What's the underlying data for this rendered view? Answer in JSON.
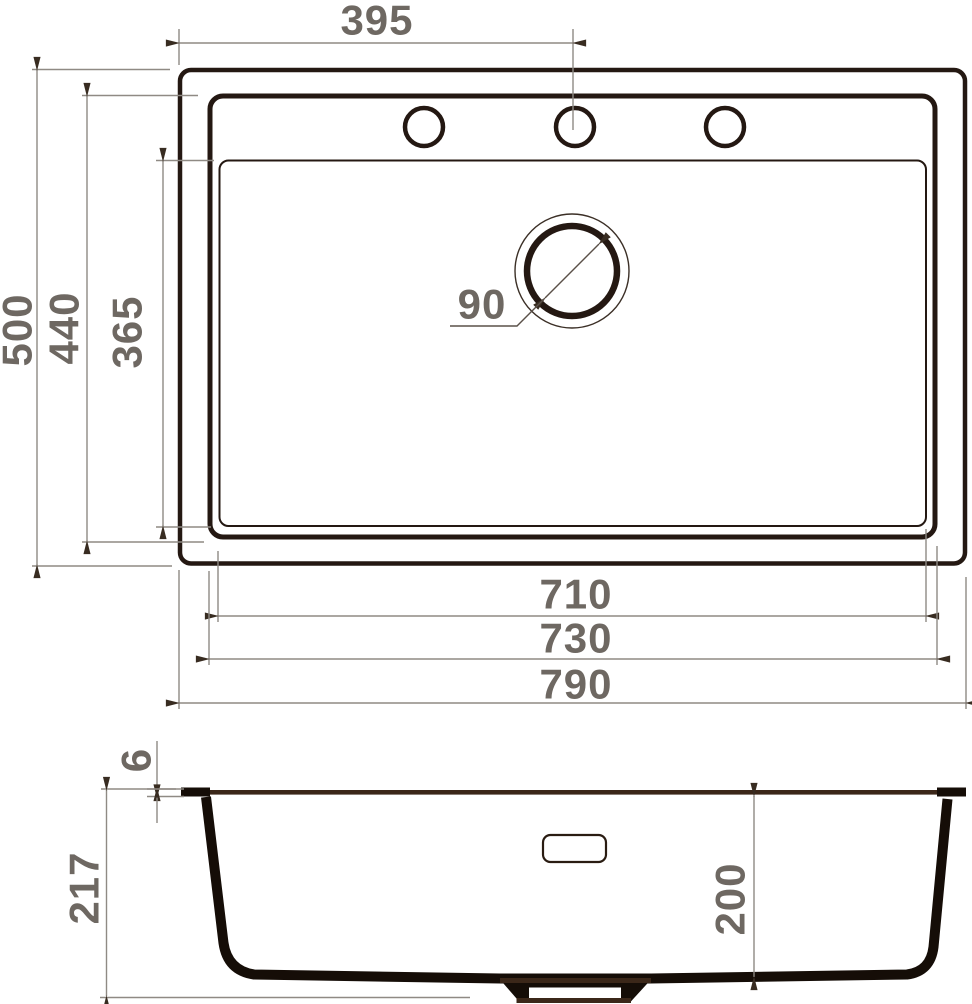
{
  "drawing": {
    "title": "Kitchen sink dimension drawing",
    "views": [
      "top-view",
      "side-section-view"
    ],
    "faucet_hole_count": 3,
    "colors": {
      "outline_dark": "#241812",
      "section_fill": "#150d07",
      "surface_brown": "#3b2719",
      "dimension_line": "#8f8a84",
      "dimension_text": "#6e6862",
      "background": "#ffffff"
    }
  },
  "dims": {
    "faucet_offset": "395",
    "overall_depth": "500",
    "rim_depth": "440",
    "bowl_depth": "365",
    "drain_diameter": "90",
    "bowl_bottom_width": "710",
    "bowl_width": "730",
    "overall_width": "790",
    "rim_thickness": "6",
    "overall_height": "217",
    "bowl_inner_depth": "200"
  }
}
